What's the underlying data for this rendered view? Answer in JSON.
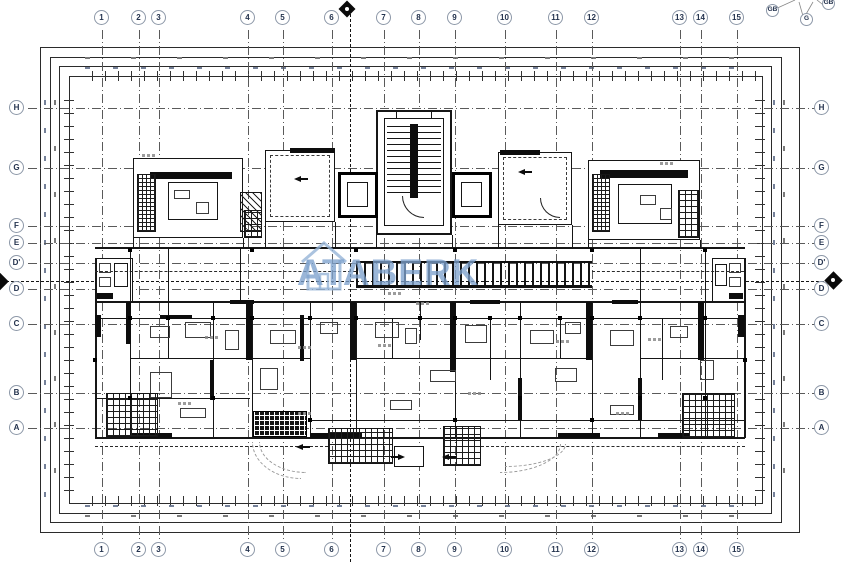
{
  "watermark": {
    "text": "ATABERK",
    "color": "#7da2cd"
  },
  "grid": {
    "cols": [
      "1",
      "2",
      "3",
      "4",
      "5",
      "6",
      "7",
      "8",
      "9",
      "10",
      "11",
      "12",
      "13",
      "14",
      "15"
    ],
    "rows": [
      "H",
      "G",
      "F",
      "E",
      "D'",
      "D",
      "C",
      "B",
      "A"
    ],
    "corner": [
      "GB",
      "G",
      "GB"
    ]
  },
  "colors": {
    "line": "#161616",
    "grid_line": "#5a5a5a",
    "bubble_outline": "#8d98a8"
  }
}
